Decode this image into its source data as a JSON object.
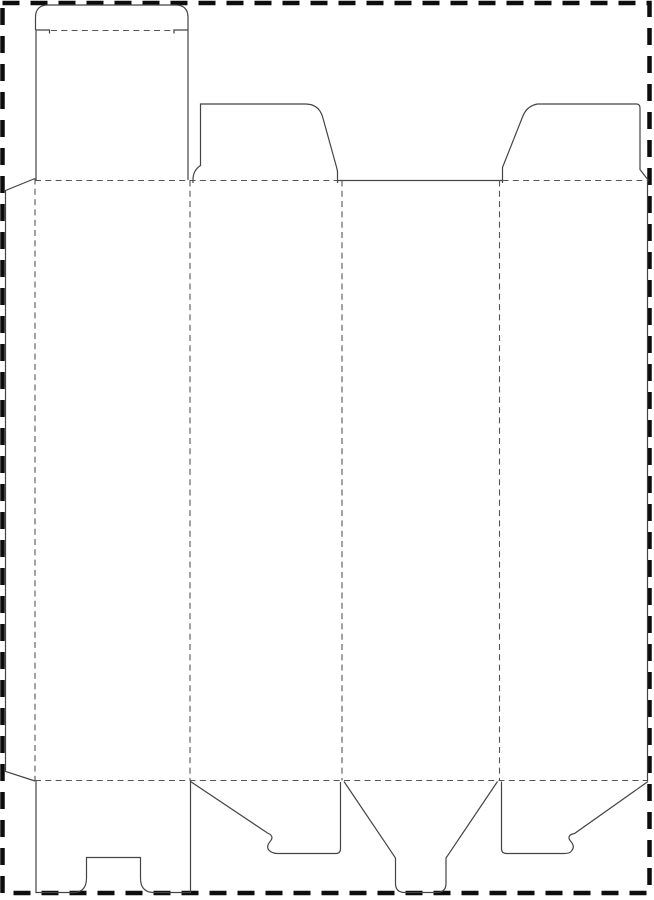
{
  "canvas": {
    "width": 654,
    "height": 900,
    "background": "#ffffff"
  },
  "styles": {
    "border": {
      "color": "#0d0d0d",
      "width": 4.5,
      "dash": "17 11"
    },
    "cut": {
      "color": "#444444",
      "width": 1.2,
      "dash": null
    },
    "fold": {
      "color": "#555555",
      "width": 1.1,
      "dash": "6 4.3"
    }
  },
  "dieline": {
    "description": "flat box die-cut template with cut lines and dashed fold lines",
    "elements": [
      {
        "name": "page-margin-border",
        "kind": "border",
        "d": "M 2.5 3 L 649.5 3 L 649.5 893 L 2.5 893 Z"
      },
      {
        "name": "tuck-lid-outline",
        "kind": "cut",
        "d": "M 35.5 30 L 35.5 17.5 Q 35.5 5 48 5 L 175.5 5 Q 188 5 188 17.5 L 188 30"
      },
      {
        "name": "lid-fold-notch-left",
        "kind": "cut",
        "d": "M 35.5 30 L 49.5 30 L 49.5 33.5"
      },
      {
        "name": "lid-fold-notch-right",
        "kind": "cut",
        "d": "M 188 30 L 174 30 L 174 33.5"
      },
      {
        "name": "lid-fold-line",
        "kind": "fold",
        "d": "M 51 30.5 L 172 30.5"
      },
      {
        "name": "top-tuck-panel-left-edge",
        "kind": "cut",
        "d": "M 36 30 L 36 180"
      },
      {
        "name": "top-tuck-panel-right-edge",
        "kind": "cut",
        "d": "M 188 30 L 188 180"
      },
      {
        "name": "top-dust-flap-left-outline",
        "kind": "cut",
        "d": "M 193 183 L 193 179.5 Q 193 170.5 200.5 165.5 L 200.5 104 L 305.5 104 Q 318.5 104 322.5 116.5 L 336.5 167 L 337.5 171.5 L 337.5 183"
      },
      {
        "name": "top-dust-flap-right-outline",
        "kind": "cut",
        "d": "M 502.5 183 L 502.5 167.5 L 522.5 117 Q 526.5 106 537.5 104 L 637 104 Q 640 104.5 640 108 L 640 169.5 L 648.5 180.5"
      },
      {
        "name": "panel3-top-cut-edge",
        "kind": "cut",
        "d": "M 338 180.5 L 502.5 180.5"
      },
      {
        "name": "top-fold-line-left",
        "kind": "fold",
        "d": "M 35 180.5 L 338 180.5"
      },
      {
        "name": "top-fold-line-right",
        "kind": "fold",
        "d": "M 502.5 180.5 L 648 180.5"
      },
      {
        "name": "bottom-fold-line",
        "kind": "fold",
        "d": "M 35 780.5 L 648 780.5"
      },
      {
        "name": "glue-flap-outline",
        "kind": "cut",
        "d": "M 35 178.5 L 5.5 190.5 L 5.5 771.5 L 35 781"
      },
      {
        "name": "glue-flap-fold-line",
        "kind": "fold",
        "d": "M 35 178.5 L 35 781"
      },
      {
        "name": "panel1-panel2-fold-line",
        "kind": "fold",
        "d": "M 190 180.5 L 190 780.5"
      },
      {
        "name": "panel2-panel3-fold-line",
        "kind": "fold",
        "d": "M 342 180.5 L 342 780.5"
      },
      {
        "name": "panel3-panel4-fold-line",
        "kind": "fold",
        "d": "M 499.5 180.5 L 499.5 780.5"
      },
      {
        "name": "panel4-right-cut-edge",
        "kind": "cut",
        "d": "M 647.5 180.5 L 647.5 781"
      },
      {
        "name": "bottom-flap-panel1-lock-slot-outline",
        "kind": "cut",
        "d": "M 36 781 L 36 892.5 L 74 892.5 Q 86.5 892 86.5 878 L 86.5 857.5 L 140.5 857.5 L 140.5 878 Q 140.5 892 153 892.5 L 190.5 892.5 L 190.5 781"
      },
      {
        "name": "bottom-flap-panel2-hook-outline",
        "kind": "cut",
        "d": "M 190.5 781.5 L 267.5 833 C 271.5 834.5 273.5 837.5 270.5 841 C 267 845 266.5 849 270.5 851.5 Q 273.5 853.5 278 853.5 L 336 853.5 Q 340.5 853.5 340.5 848.5 L 340.5 782"
      },
      {
        "name": "bottom-tuck-tongue-outline",
        "kind": "cut",
        "d": "M 344 781.5 L 395.5 858 L 395.5 883.5 Q 395.5 892.5 405 892.5 L 436.5 892.5 Q 446 892.5 446 883.5 L 446 858 L 497.5 781.5"
      },
      {
        "name": "bottom-flap-panel4-hook-outline",
        "kind": "cut",
        "d": "M 501.5 781.5 L 501.5 848.5 Q 501.5 853.5 506.5 853.5 L 564 853.5 Q 570 853.5 571.5 851 C 574.5 847.5 573.5 844.5 570.5 841 C 567.5 837.5 569 834.5 574.5 833.5 L 648 781.5"
      }
    ]
  }
}
